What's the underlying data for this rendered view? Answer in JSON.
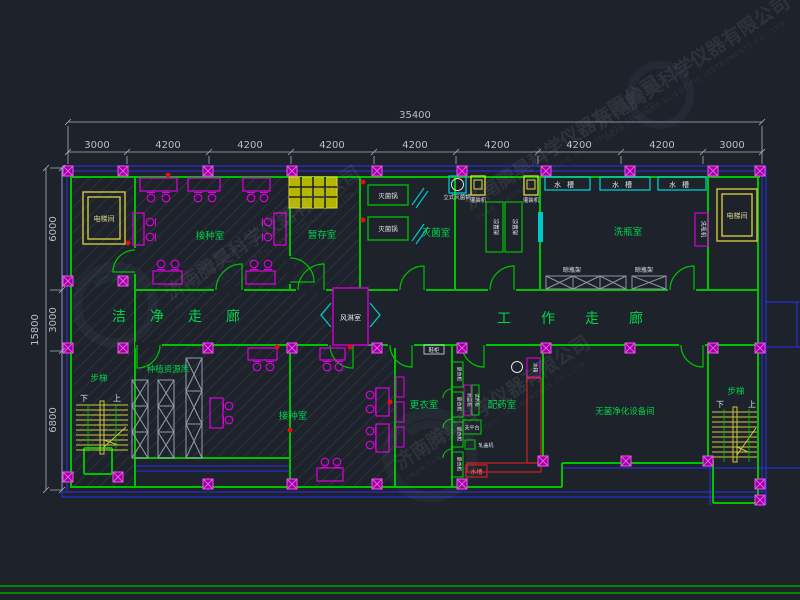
{
  "drawing": {
    "dims": {
      "total_width": "35400",
      "top_segments": [
        "3000",
        "4200",
        "4200",
        "4200",
        "4200",
        "4200",
        "4200",
        "4200",
        "3000"
      ],
      "total_height": "15800",
      "left_segments": [
        "6000",
        "3000",
        "6800"
      ]
    },
    "rooms": {
      "elevator": "电梯间",
      "inoculation": "接种室",
      "temp_storage": "暂存室",
      "sterilization": "灭菌室",
      "bottle_wash": "洗瓶室",
      "clean_corridor": "洁净走廊",
      "work_corridor": "工作走廊",
      "air_shower": "风淋室",
      "stairs": "步梯",
      "resource_library": "种植资源库",
      "changing": "更衣室",
      "pharmacy": "配药室",
      "sterile_equipment": "无菌净化设备间"
    },
    "equipment": {
      "sterilizer_pot": "灭菌锅",
      "vertical_sterilizer": "立式灭菌锅",
      "filling_machine": "灌装机",
      "cooling_rack": "凉置架",
      "sink": "水槽",
      "bottle_washer": "洗瓶机",
      "drying_rack": "晾瓶架",
      "wardrobe": "更衣柜",
      "shoe_cabinet": "鞋柜",
      "fridge": "冰箱",
      "medicine_cabinet": "药品柜",
      "reagent_cabinet": "试剂柜",
      "balance": "天平台",
      "capper": "轧盖机",
      "up": "上",
      "down": "下"
    },
    "watermark": {
      "cn": "济南腾昊科学仪器有限公司",
      "en": "JINAN TENGHAO SCIENTIFIC INSTRUMENTS CO., LTD."
    }
  }
}
